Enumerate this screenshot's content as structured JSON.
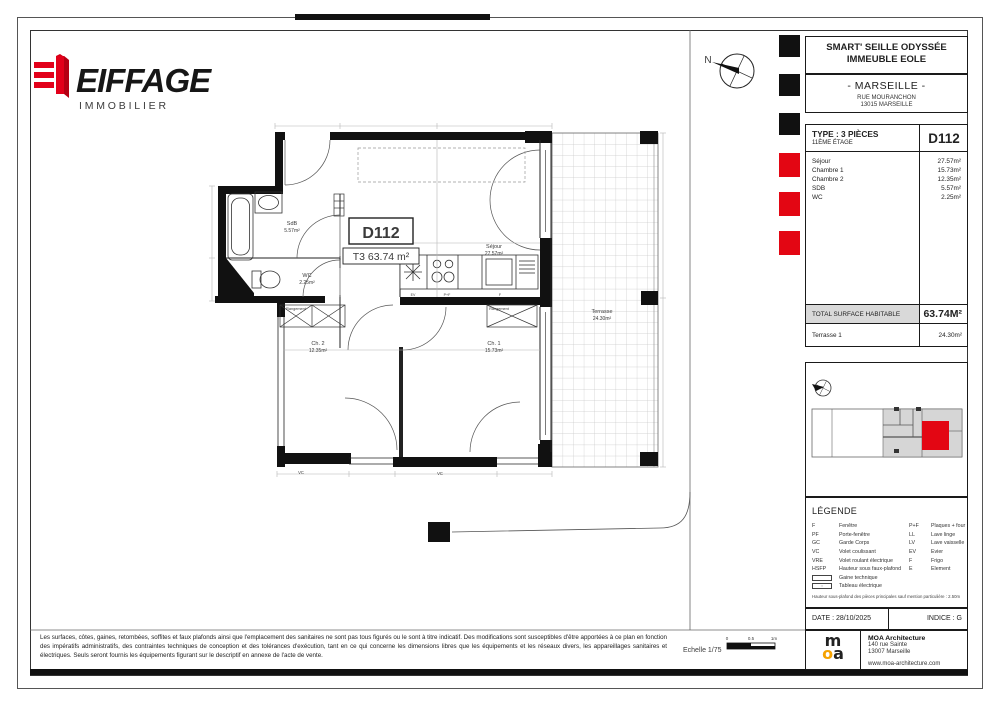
{
  "logo": {
    "brand": "EIFFAGE",
    "sub": "IMMOBILIER"
  },
  "title_block": {
    "project_line1": "SMART' SEILLE ODYSSÉE",
    "project_line2": "IMMEUBLE EOLE",
    "city": "- MARSEILLE -",
    "address_line1": "RUE MOURANCHON",
    "address_line2": "13015 MARSEILLE"
  },
  "unit": {
    "type_label": "TYPE : 3 PIÈCES",
    "floor_label": "11ÈME ÉTAGE",
    "unit_id": "D112",
    "rooms": [
      {
        "name": "Séjour",
        "area": "27.57m²"
      },
      {
        "name": "Chambre 1",
        "area": "15.73m²"
      },
      {
        "name": "Chambre 2",
        "area": "12.35m²"
      },
      {
        "name": "SDB",
        "area": "5.57m²"
      },
      {
        "name": "WC",
        "area": "2.25m²"
      }
    ],
    "total_label": "TOTAL SURFACE HABITABLE",
    "total_area": "63.74M²",
    "terrace_name": "Terrasse 1",
    "terrace_area": "24.30m²"
  },
  "plan": {
    "north": "N",
    "unit_box": "D112",
    "type_box": "T3 63.74 m²",
    "rooms": {
      "sejour": {
        "name": "Séjour",
        "area": "27.57m²"
      },
      "ch1": {
        "name": "Ch. 1",
        "area": "15.73m²"
      },
      "ch2": {
        "name": "Ch. 2",
        "area": "12.35m²"
      },
      "sdb": {
        "name": "SdB",
        "area": "5.57m²"
      },
      "wc": {
        "name": "WC",
        "area": "2.25m²"
      },
      "terrasse": {
        "name": "Terrasse",
        "area": "24.30m²"
      }
    },
    "annotations": {
      "rangement1": "Rangement",
      "rangement2": "Rangement",
      "vc1": "VC",
      "vc2": "VC",
      "ev": "EV",
      "pf": "P+F",
      "f": "F"
    }
  },
  "legend": {
    "title": "LÉGENDE",
    "left": [
      {
        "abbr": "F",
        "label": "Fenêtre"
      },
      {
        "abbr": "PF",
        "label": "Porte-fenêtre"
      },
      {
        "abbr": "GC",
        "label": "Garde Corps"
      },
      {
        "abbr": "VC",
        "label": "Volet coulissant"
      },
      {
        "abbr": "VRE",
        "label": "Volet roulant électrique"
      },
      {
        "abbr": "HSFP",
        "label": "Hauteur sous faux-plafond"
      }
    ],
    "right": [
      {
        "abbr": "P+F",
        "label": "Plaques + four"
      },
      {
        "abbr": "LL",
        "label": "Lave linge"
      },
      {
        "abbr": "LV",
        "label": "Lave vaisselle"
      },
      {
        "abbr": "EV",
        "label": "Evier"
      },
      {
        "abbr": "F",
        "label": "Frigo"
      },
      {
        "abbr": "E",
        "label": "Element"
      }
    ],
    "gaine_label": "Gaine technique",
    "tableau_label": "Tableau électrique",
    "note": "Hauteur sous-plafond des pièces principales sauf mention particulière : 2.50m"
  },
  "footer": {
    "date_label": "DATE : 28/10/2025",
    "indice_label": "INDICE : G",
    "architect": {
      "name": "MOA Architecture",
      "address_line1": "140 rue Sainte",
      "address_line2": "13007 Marseille",
      "website": "www.moa-architecture.com",
      "logo_m": "m",
      "logo_o": "o",
      "logo_a": "a"
    },
    "disclaimer": "Les surfaces, côtes, gaines, retombées, soffites et faux plafonds ainsi que l'emplacement des sanitaires ne sont pas tous figurés ou le sont à titre indicatif. Des modifications sont susceptibles d'être apportées à ce plan en fonction des impératifs administratifs, des contraintes techniques de conception et des tolérances d'exécution, tant en ce qui concerne les dimensions libres que les équipements et les réseaux divers, les appareillages sanitaires et électriques. Seuls seront fournis les équipements figurant sur le descriptif en annexe de l'acte de vente.",
    "scale_label": "Echelle 1/75",
    "scale_ticks": [
      "0",
      "0.5",
      "1m"
    ]
  },
  "colors": {
    "brand_red": "#E2001A",
    "moa_orange": "#F5A200",
    "mark_red": "#E30613",
    "band_gray": "#D9D9D9"
  }
}
